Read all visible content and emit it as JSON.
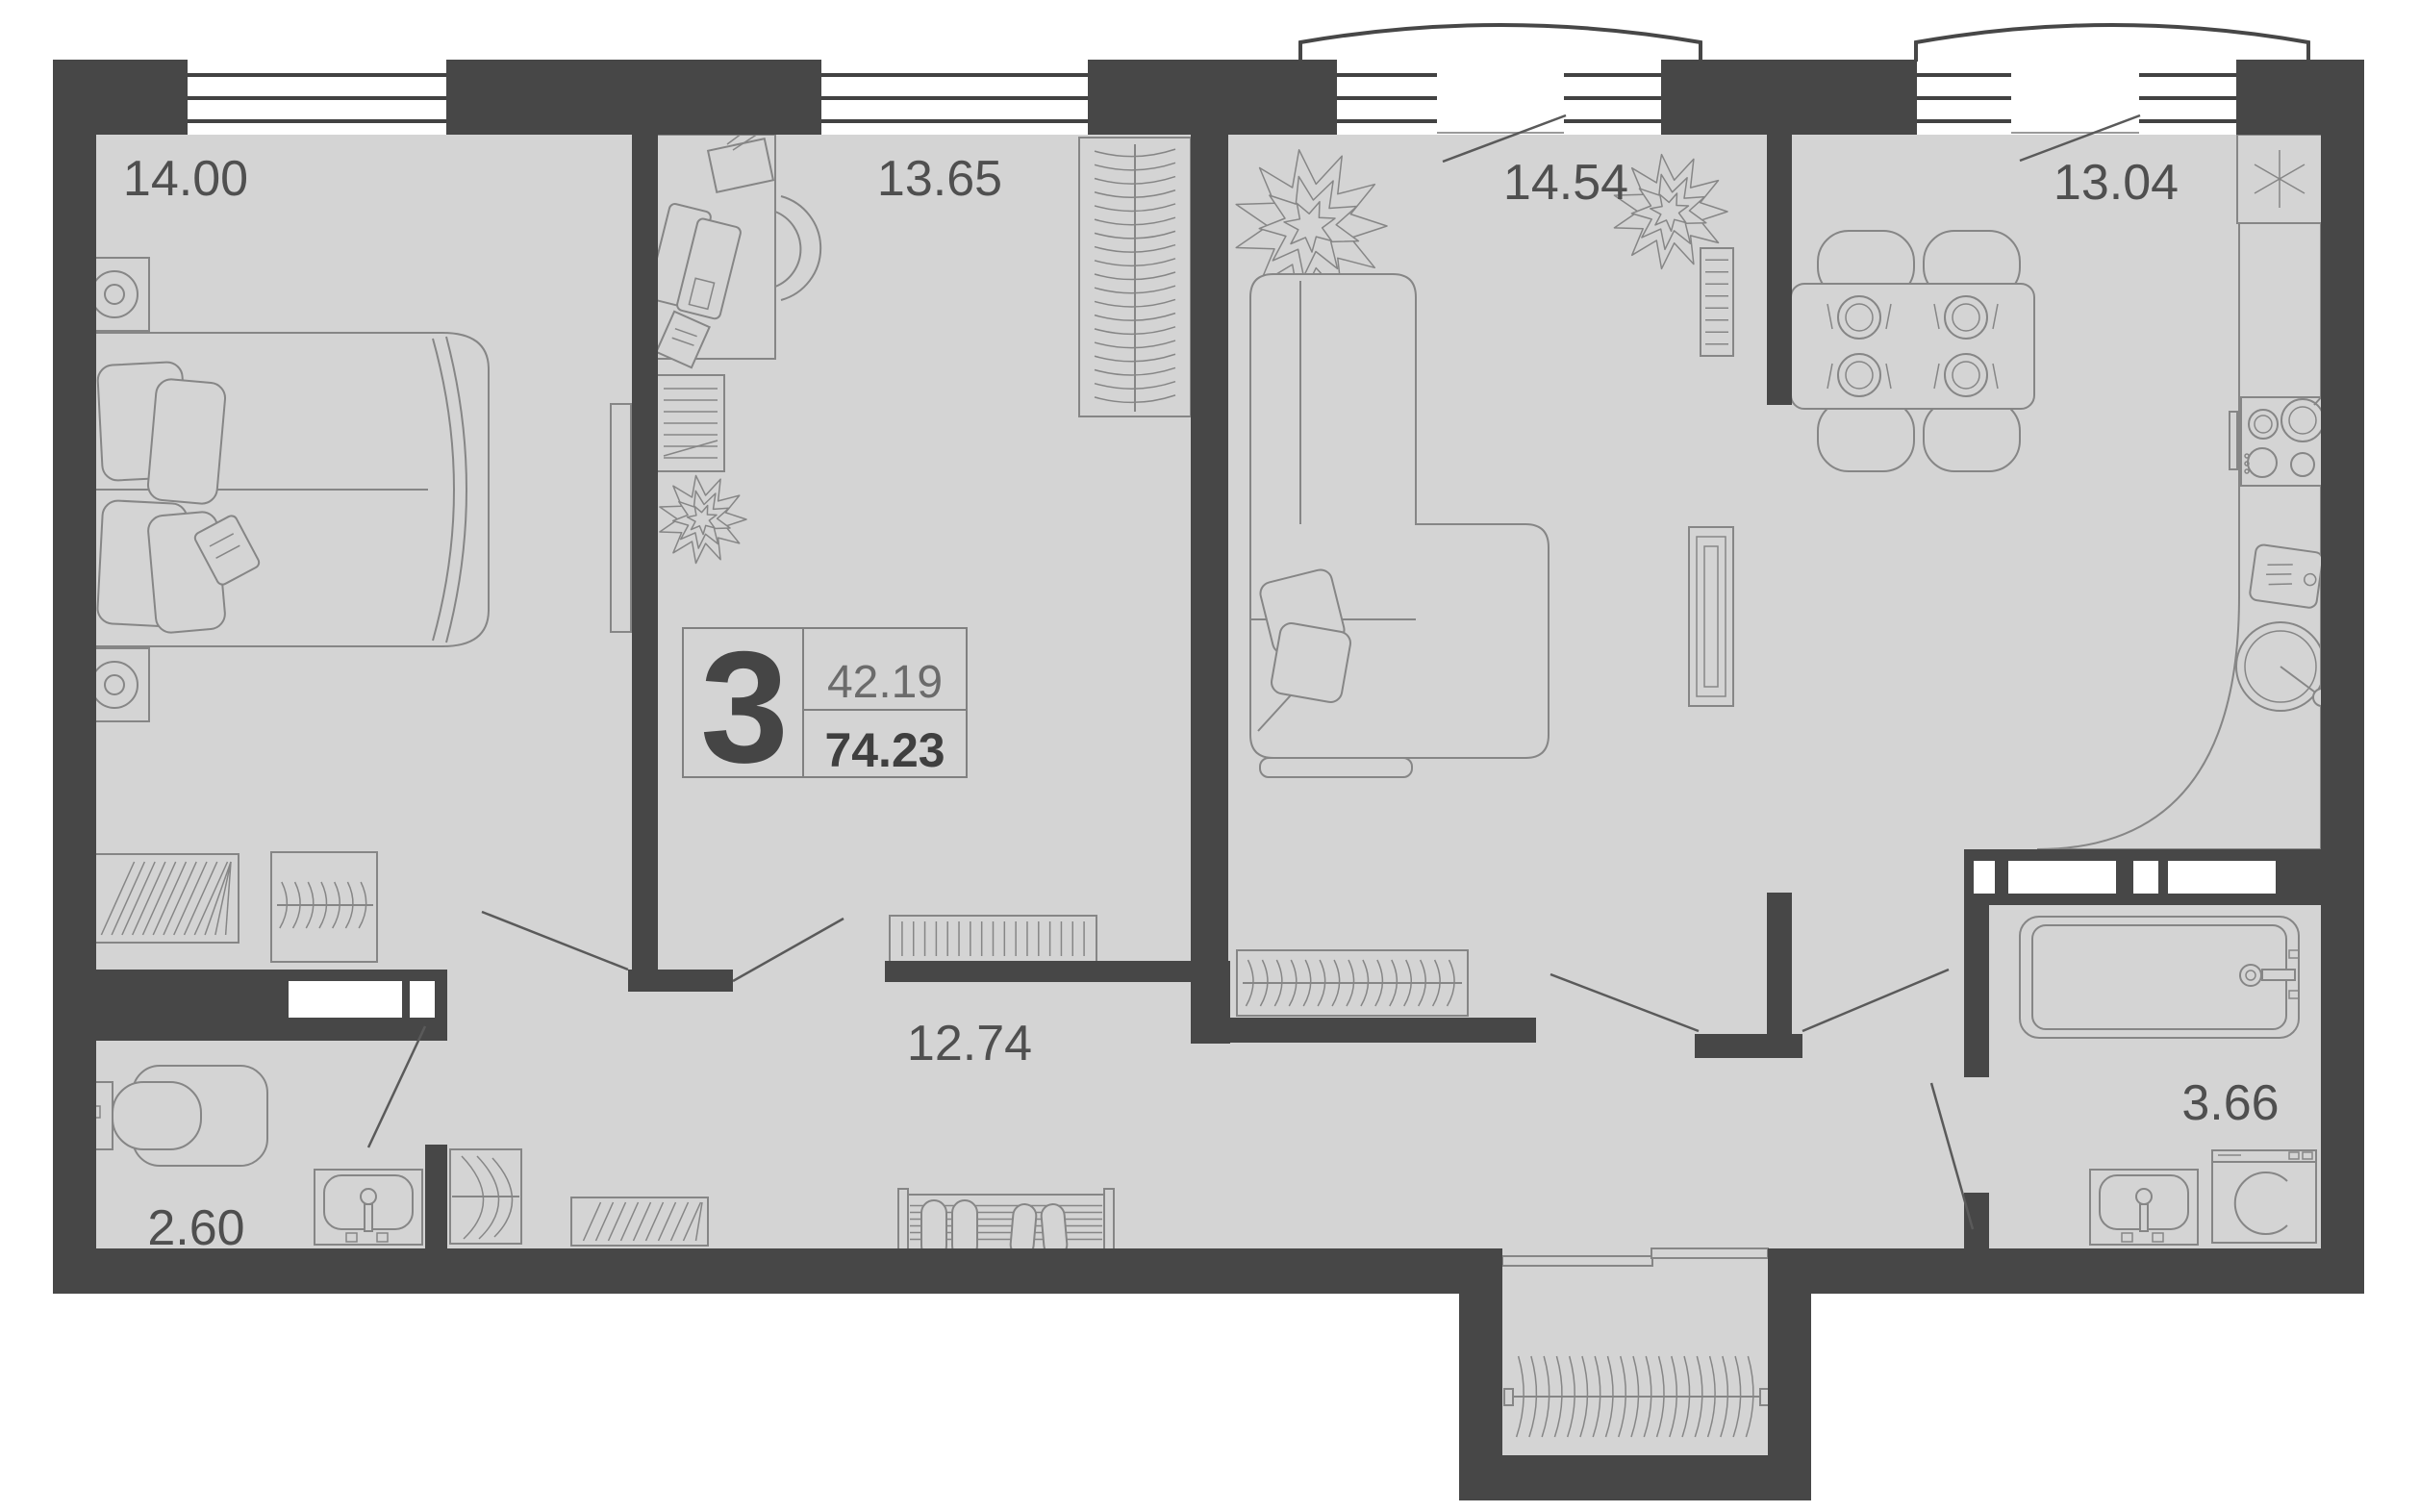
{
  "floor_plan": {
    "badge": {
      "rooms_count": "3",
      "living_area": "42.19",
      "total_area": "74.23"
    },
    "room_labels": {
      "bedroom": "14.00",
      "office": "13.65",
      "living_room": "14.54",
      "kitchen": "13.04",
      "hallway": "12.74",
      "wc": "2.60",
      "bathroom": "3.66"
    },
    "icons": {
      "fridge": "✳"
    }
  },
  "colors": {
    "wall": "#474747",
    "floor": "#d4d4d4",
    "furniture_line": "#868686",
    "window_line": "#424242",
    "label": "#4f4f4f",
    "background": "#ffffff"
  }
}
